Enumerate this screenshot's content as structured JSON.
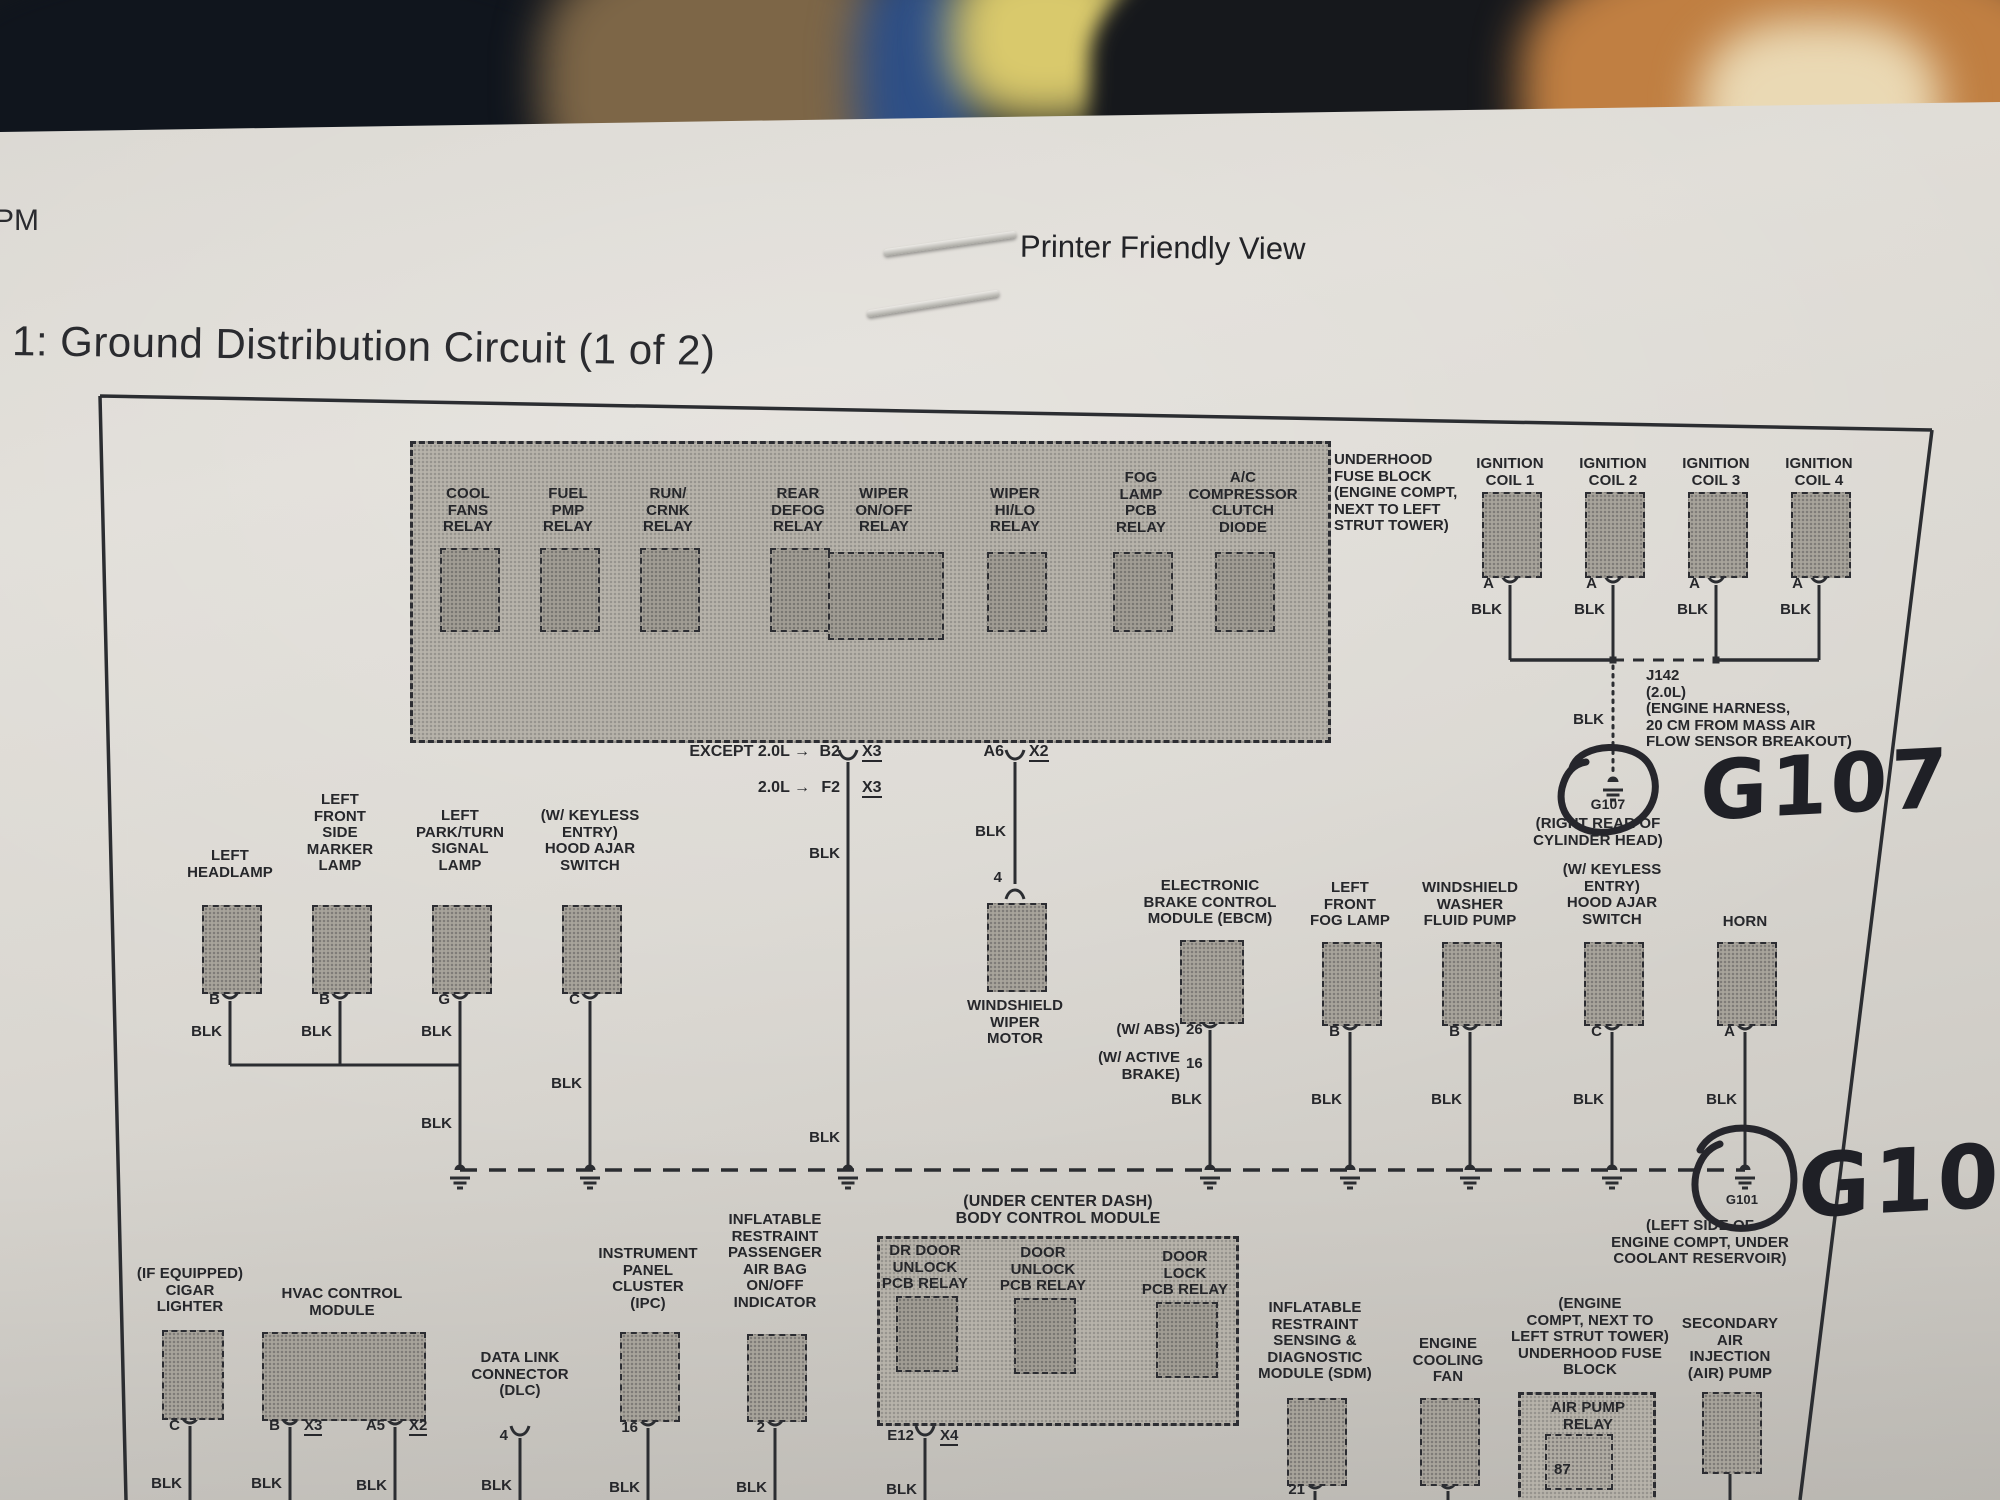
{
  "header": {
    "pm": "PM",
    "printer_friendly": "Printer Friendly View",
    "title": "1: Ground Distribution Circuit (1 of 2)"
  },
  "labels": {
    "blk": "BLK"
  },
  "fuse1": {
    "side_label": "UNDERHOOD\nFUSE BLOCK\n(ENGINE COMPT,\nNEXT TO LEFT\nSTRUT TOWER)",
    "relays": [
      "COOL\nFANS\nRELAY",
      "FUEL\nPMP\nRELAY",
      "RUN/\nCRNK\nRELAY",
      "REAR\nDEFOG\nRELAY",
      "WIPER\nON/OFF\nRELAY",
      "WIPER\nHI/LO\nRELAY",
      "FOG\nLAMP\nPCB\nRELAY",
      "A/C\nCOMPRESSOR\nCLUTCH\nDIODE"
    ]
  },
  "exits": {
    "except_20l": "EXCEPT 2.0L →",
    "b2": "B2",
    "x3a": "X3",
    "only_20l": "2.0L →",
    "f2": "F2",
    "x3b": "X3",
    "a6": "A6",
    "x2": "X2"
  },
  "coils": {
    "c1": "IGNITION\nCOIL 1",
    "c2": "IGNITION\nCOIL 2",
    "c3": "IGNITION\nCOIL 3",
    "c4": "IGNITION\nCOIL 4",
    "pin": "A",
    "j142": "J142\n(2.0L)\n(ENGINE HARNESS,\n20 CM FROM MASS AIR\nFLOW SENSOR BREAKOUT)"
  },
  "g107": {
    "printed": "G107",
    "caption": "(RIGHT REAR OF\nCYLINDER HEAD)",
    "hand": "G107"
  },
  "g101": {
    "printed": "G101",
    "caption": "(LEFT SIDE OF\nENGINE COMPT, UNDER\nCOOLANT RESERVOIR)",
    "hand": "G101"
  },
  "mid": {
    "headlamp": {
      "label": "LEFT\nHEADLAMP",
      "pin": "B"
    },
    "marker": {
      "label": "LEFT\nFRONT\nSIDE\nMARKER\nLAMP",
      "pin": "B"
    },
    "parkturn": {
      "label": "LEFT\nPARK/TURN\nSIGNAL\nLAMP",
      "pin": "G"
    },
    "hoodajar1": {
      "label": "(W/ KEYLESS\nENTRY)\nHOOD AJAR\nSWITCH",
      "pin": "C"
    },
    "wiper_motor": {
      "label": "WINDSHIELD\nWIPER\nMOTOR",
      "pin": "4"
    },
    "ebcm": {
      "label": "ELECTRONIC\nBRAKE CONTROL\nMODULE (EBCM)",
      "abs": "(W/ ABS)",
      "abs_pin": "26",
      "active": "(W/ ACTIVE\nBRAKE)",
      "active_pin": "16"
    },
    "fog": {
      "label": "LEFT\nFRONT\nFOG LAMP",
      "pin": "B"
    },
    "washer": {
      "label": "WINDSHIELD\nWASHER\nFLUID PUMP",
      "pin": "B"
    },
    "hoodajar2": {
      "label": "(W/ KEYLESS\nENTRY)\nHOOD AJAR\nSWITCH",
      "pin": "C"
    },
    "horn": {
      "label": "HORN",
      "pin": "A"
    }
  },
  "bottom": {
    "cigar": {
      "label": "(IF EQUIPPED)\nCIGAR\nLIGHTER",
      "pin": "C"
    },
    "hvac": {
      "label": "HVAC CONTROL\nMODULE",
      "pin_b": "B",
      "x3": "X3",
      "pin_a5": "A5",
      "x2": "X2"
    },
    "dlc": {
      "label": "DATA LINK\nCONNECTOR\n(DLC)",
      "pin": "4"
    },
    "ipc": {
      "label": "INSTRUMENT\nPANEL\nCLUSTER\n(IPC)",
      "pin": "16"
    },
    "airbag": {
      "label": "INFLATABLE\nRESTRAINT\nPASSENGER\nAIR BAG\nON/OFF\nINDICATOR",
      "pin": "2"
    },
    "bcm": {
      "header": "(UNDER CENTER DASH)\nBODY CONTROL MODULE",
      "r1": "DR DOOR\nUNLOCK\nPCB RELAY",
      "r2": "DOOR\nUNLOCK\nPCB RELAY",
      "r3": "DOOR\nLOCK\nPCB RELAY",
      "e12": "E12",
      "x4": "X4"
    },
    "sdm": {
      "label": "INFLATABLE\nRESTRAINT\nSENSING &\nDIAGNOSTIC\nMODULE (SDM)",
      "pin": "21"
    },
    "fan": {
      "label": "ENGINE\nCOOLING\nFAN"
    },
    "uhfb2": {
      "label": "(ENGINE\nCOMPT, NEXT TO\nLEFT STRUT TOWER)\nUNDERHOOD FUSE\nBLOCK",
      "relay": "AIR PUMP\nRELAY",
      "pin": "87"
    },
    "secair": {
      "label": "SECONDARY\nAIR\nINJECTION\n(AIR) PUMP"
    }
  }
}
